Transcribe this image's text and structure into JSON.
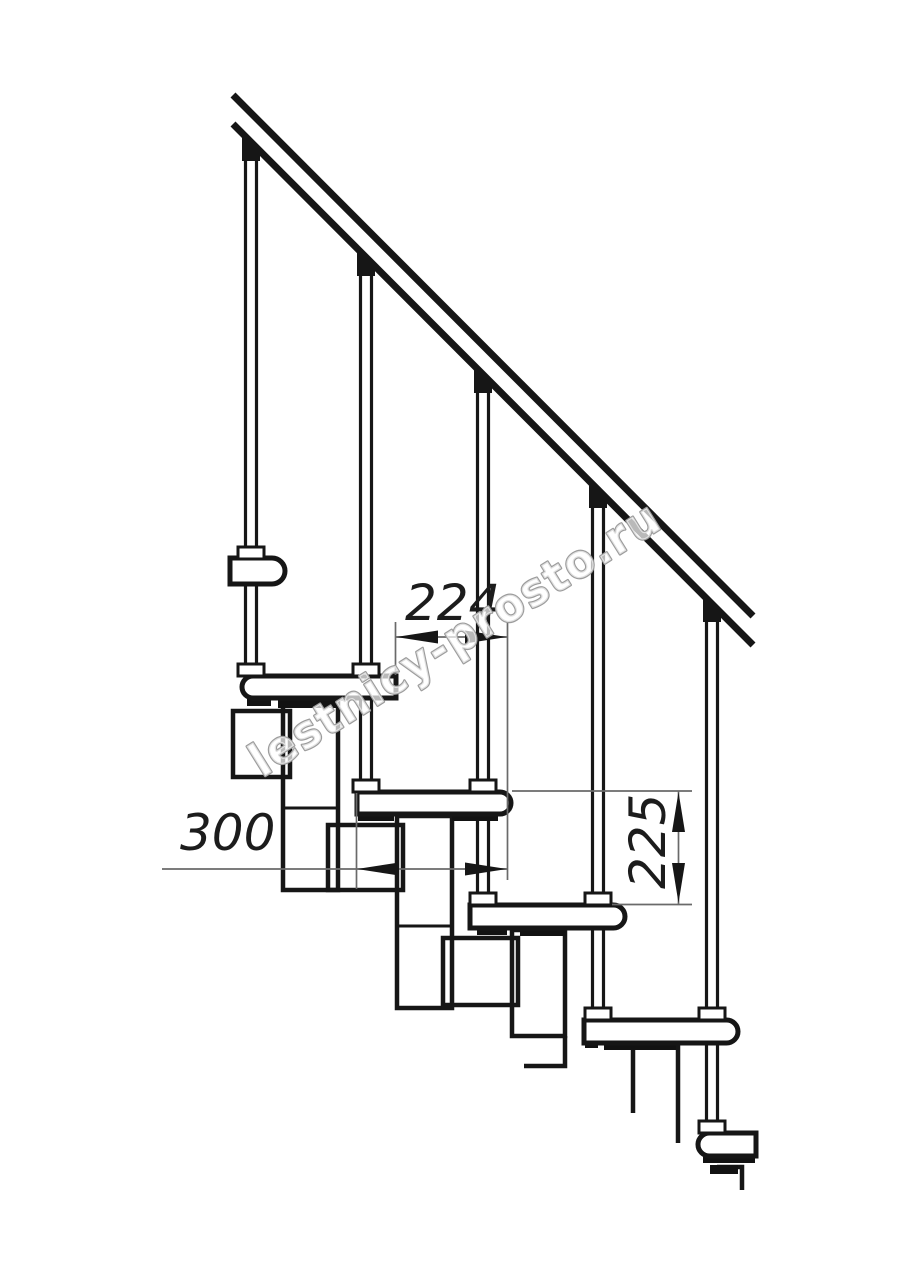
{
  "drawing": {
    "title": "Modular staircase side elevation - technical drawing",
    "watermark": {
      "text": "lestnicy-prosto.ru"
    },
    "dimensions": [
      {
        "id": "dim-224",
        "value": "224",
        "orientation": "horizontal"
      },
      {
        "id": "dim-300",
        "value": "300",
        "orientation": "horizontal"
      },
      {
        "id": "dim-225",
        "value": "225",
        "orientation": "vertical"
      }
    ],
    "counts": {
      "balusters": 5,
      "treads": 5
    },
    "colors": {
      "line": "#161616",
      "dimension_line": "#6a6a6a",
      "watermark_outline": "#9c9c9c",
      "fill": "#ffffff"
    }
  }
}
